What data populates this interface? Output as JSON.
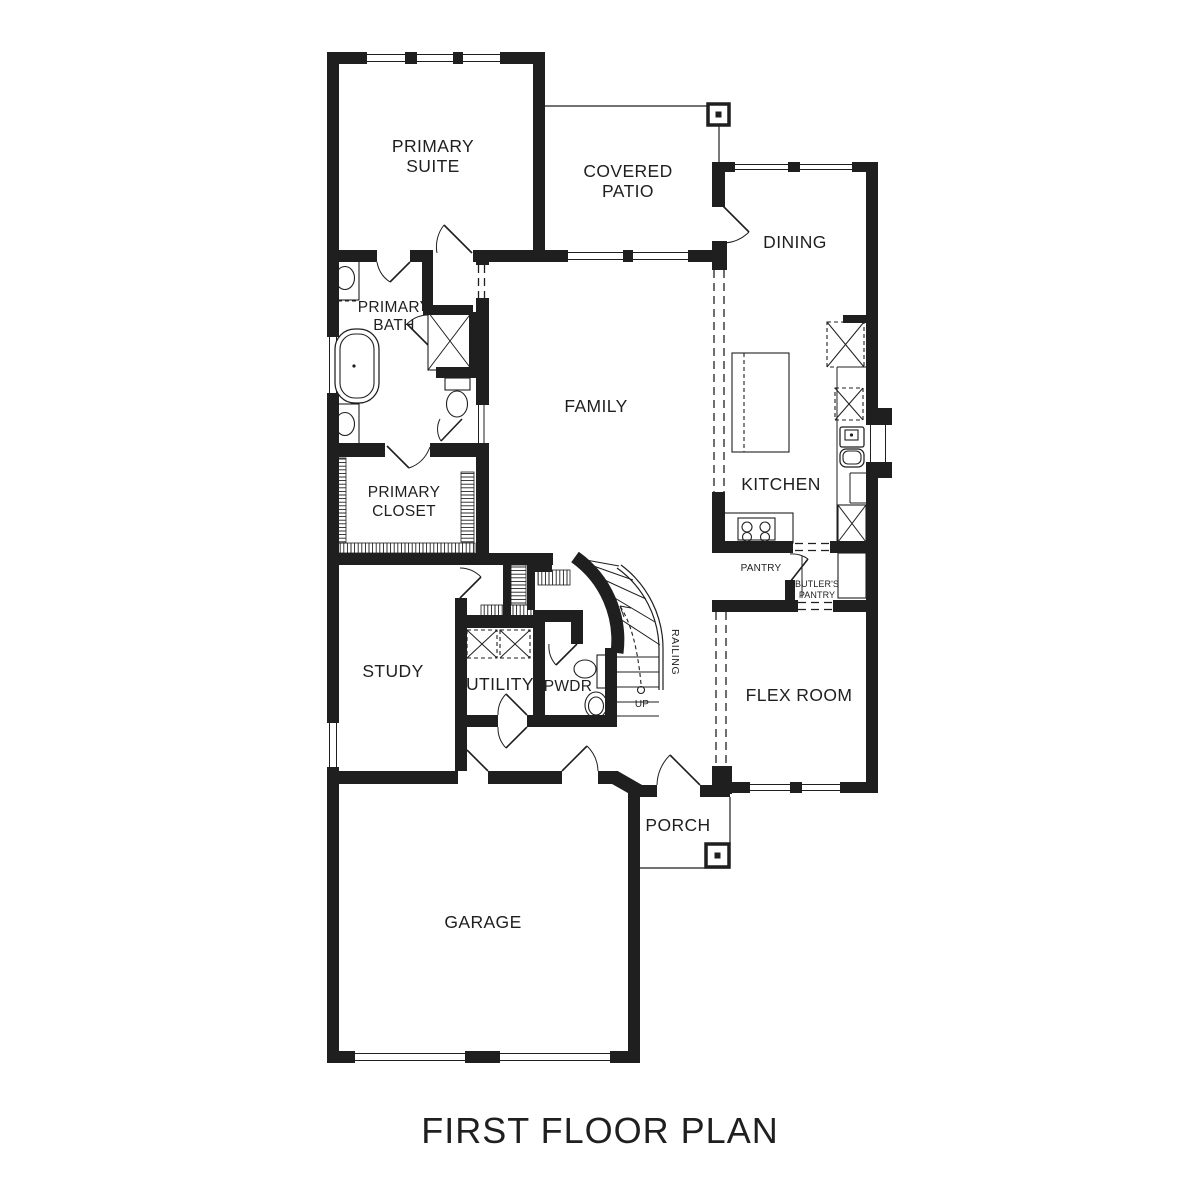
{
  "title": "FIRST FLOOR PLAN",
  "colors": {
    "ink": "#1f1f1f",
    "paper": "#ffffff"
  },
  "rooms": {
    "primary_suite": [
      "PRIMARY",
      "SUITE"
    ],
    "covered_patio": [
      "COVERED",
      "PATIO"
    ],
    "dining": "DINING",
    "family": "FAMILY",
    "kitchen": "KITCHEN",
    "primary_bath": [
      "PRIMARY",
      "BATH"
    ],
    "primary_closet": [
      "PRIMARY",
      "CLOSET"
    ],
    "study": "STUDY",
    "utility": "UTILITY",
    "powder": "PWDR",
    "pantry": "PANTRY",
    "butlers_pantry": [
      "BUTLER'S",
      "PANTRY"
    ],
    "flex_room": "FLEX ROOM",
    "porch": "PORCH",
    "garage": "GARAGE"
  },
  "stair": {
    "railing": "RAILING",
    "up": "UP"
  }
}
